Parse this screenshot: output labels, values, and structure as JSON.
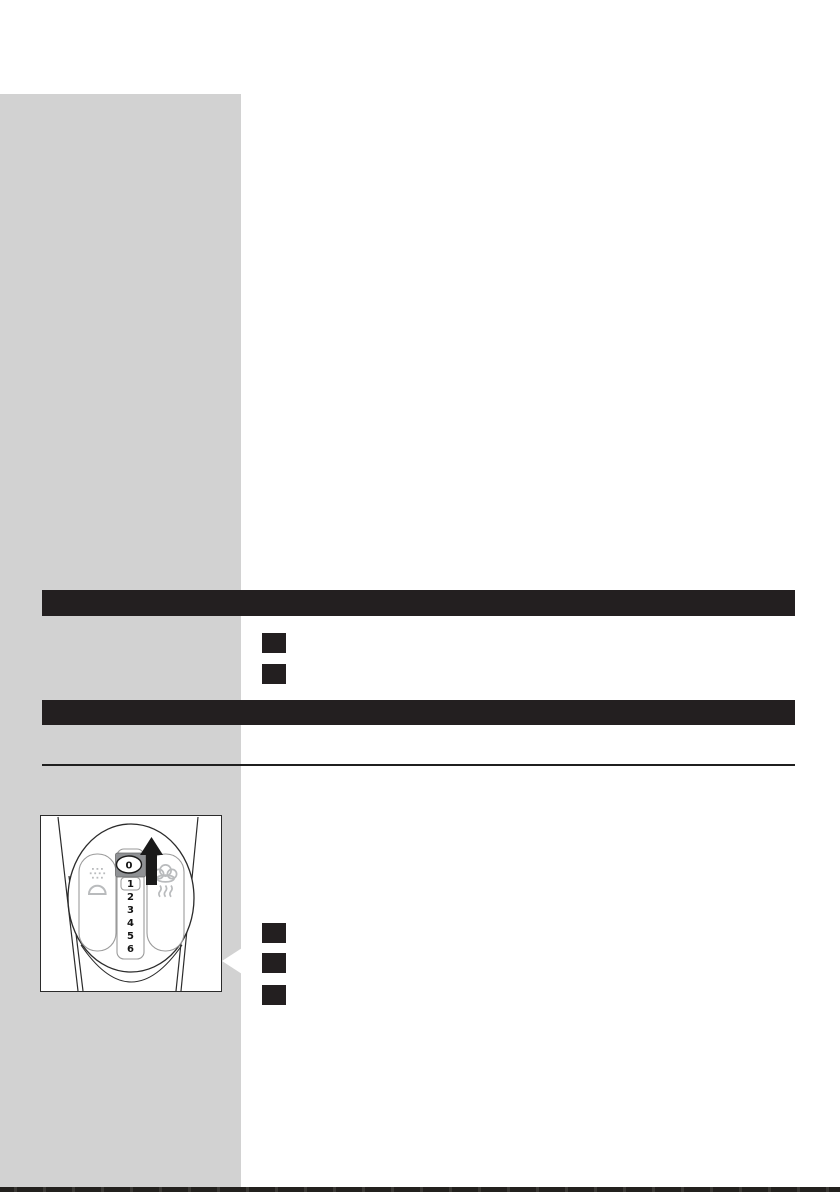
{
  "document": {
    "kind": "scanned-manual-page",
    "dial_numbers": [
      "0",
      "1",
      "2",
      "3",
      "4",
      "5",
      "6"
    ],
    "selected_setting": "0"
  },
  "header_bars": [
    {
      "label": ""
    },
    {
      "label": ""
    }
  ],
  "steps_upper": [
    {
      "marker": ""
    },
    {
      "marker": ""
    }
  ],
  "steps_lower": [
    {
      "marker": ""
    },
    {
      "marker": ""
    },
    {
      "marker": ""
    }
  ],
  "illustration": {
    "name": "steam-control-dial-set-to-0",
    "icons": [
      "spray-icon",
      "steam-icon",
      "arrow-up-icon"
    ]
  },
  "colors": {
    "sidebar_gray": "#d2d2d2",
    "header_bar_black": "#231f20",
    "step_marker_black": "#231f20",
    "icon_gray": "#b9bbbd",
    "knob_gray": "#8f9194",
    "outline_dark": "#2b2b2b",
    "page_white": "#ffffff"
  }
}
